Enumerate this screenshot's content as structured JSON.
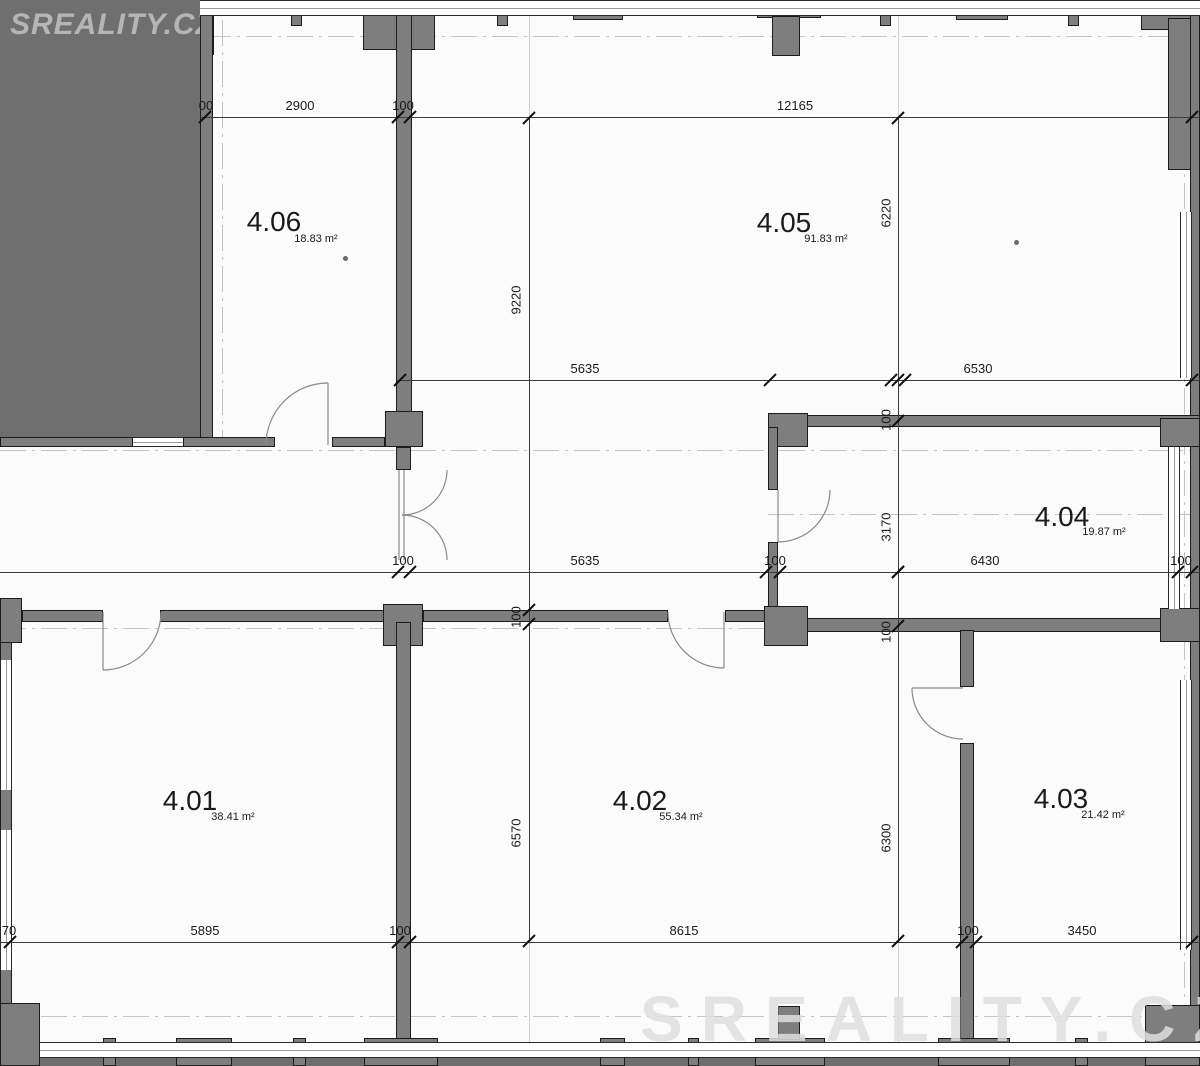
{
  "logo": {
    "text": "SREALITY.CZ"
  },
  "watermark": {
    "text": "SREALITY.CZ"
  },
  "rooms": [
    {
      "id": "4.01",
      "area": "38.41 m²"
    },
    {
      "id": "4.02",
      "area": "55.34 m²"
    },
    {
      "id": "4.03",
      "area": "21.42 m²"
    },
    {
      "id": "4.04",
      "area": "19.87 m²"
    },
    {
      "id": "4.05",
      "area": "91.83 m²"
    },
    {
      "id": "4.06",
      "area": "18.83 m²"
    }
  ],
  "dimensions": {
    "top": [
      "00",
      "2900",
      "100",
      "12165"
    ],
    "middle": [
      "5635",
      "6530"
    ],
    "corridor": [
      "100",
      "5635",
      "100",
      "6430",
      "100"
    ],
    "bottom": [
      "70",
      "5895",
      "100",
      "8615",
      "100",
      "3450"
    ],
    "vertical_left": [
      "9220",
      "100",
      "6570"
    ],
    "vertical_right": [
      "6220",
      "100",
      "3170",
      "100",
      "6300"
    ]
  },
  "colors": {
    "outside_gray": "#6f6f6f",
    "wall_gray": "#7e7e7e",
    "paper": "#fbfbfb",
    "line_dark": "#1a1a1a"
  }
}
